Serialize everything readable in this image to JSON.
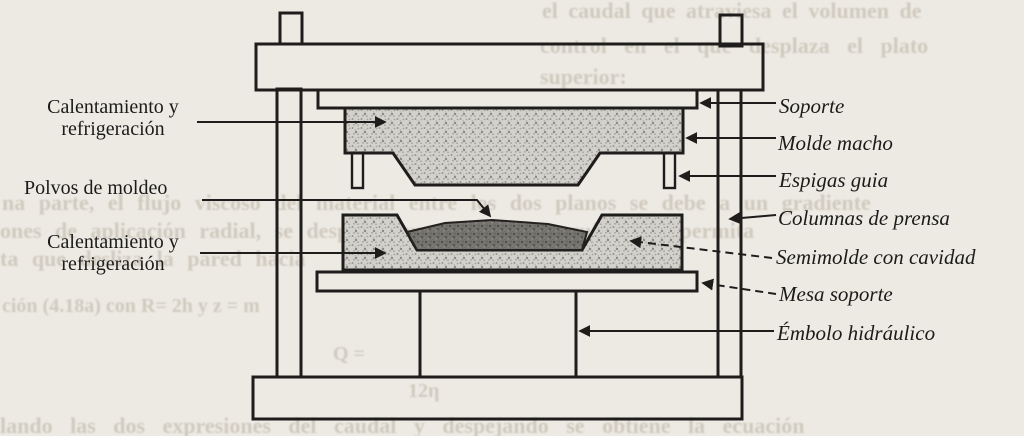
{
  "page": {
    "kind": "scanned textbook diagram",
    "subject": "compression molding press (prensa de moldeo por compresión)"
  },
  "colors": {
    "paper": "#edeae4",
    "ink": "#1e1d1b",
    "mold_stipple": "#d3d1cc",
    "powder": "#75736e",
    "ghost_text": "#b4ac9a"
  },
  "labels": {
    "calentamiento_top_1": "Calentamiento y",
    "calentamiento_top_2": "refrigeración",
    "polvos": "Polvos de moldeo",
    "calentamiento_bottom_1": "Calentamiento y",
    "calentamiento_bottom_2": "refrigeración",
    "soporte": "Soporte",
    "molde_macho": "Molde macho",
    "espigas_guia": "Espigas guia",
    "columnas_prensa": "Columnas de prensa",
    "semimolde": "Semimolde con cavidad",
    "mesa_soporte": "Mesa soporte",
    "embolo": "Émbolo hidráulico"
  },
  "ghost": {
    "g1": "el caudal que atraviesa el volumen de",
    "g2": "control en el que desplaza el plato",
    "g3": "superior:",
    "g4": "na parte, el flujo viscoso del material entre los dos planos se debe a un gradiente",
    "g5": "ones de aplicación radial, se desplaza en el tiempo y guía cada permita",
    "g6": "ta que desliza la pared hacia",
    "g7": "ción (4.18a) con R= 2h y z = m",
    "g8": "lando las dos expresiones del caudal y despejando se obtiene la ecuación",
    "g9": "Q =",
    "g10": "12η"
  }
}
